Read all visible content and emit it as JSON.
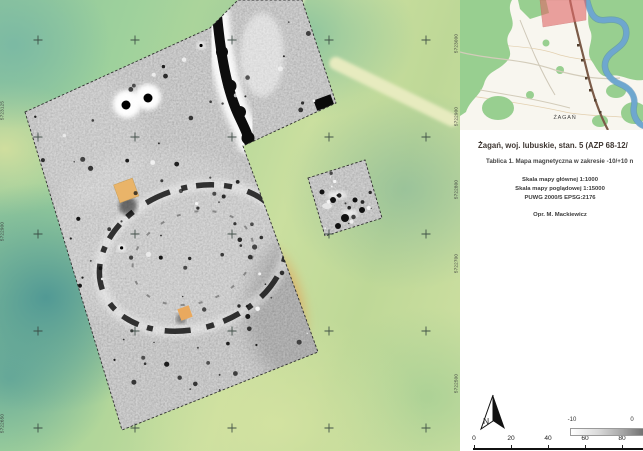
{
  "main_map": {
    "coordinate_labels": [
      {
        "text": "5723000",
        "y": 45
      },
      {
        "text": "5722900",
        "y": 118
      },
      {
        "text": "5722800",
        "y": 191
      },
      {
        "text": "5722700",
        "y": 265
      },
      {
        "text": "5722500",
        "y": 385
      }
    ]
  },
  "sidebar": {
    "edge_labels": [
      {
        "text": "5723125",
        "y": 112
      },
      {
        "text": "5722900",
        "y": 233
      },
      {
        "text": "5722650",
        "y": 425
      }
    ]
  },
  "overview_map": {
    "city_label": "ŻAGAŃ"
  },
  "info_panel": {
    "title": "Żagań, woj. lubuskie, stan. 5 (AZP 68-12/",
    "subtitle": "Tablica 1. Mapa magnetyczna w zakresie -10/+10 n",
    "scale_main": "Skala mapy głównej 1:1000",
    "scale_overview": "Skala mapy poglądowej 1:15000",
    "crs": "PUWG 2000/5 EPSG:2176",
    "author": "Opr. M. Mackiewicz"
  },
  "compass": {
    "label": "N"
  },
  "colorbar": {
    "labels": [
      {
        "text": "-10",
        "x": 572
      },
      {
        "text": "0",
        "x": 632
      }
    ]
  },
  "scalebar": {
    "ticks": [
      {
        "text": "0",
        "x": 474
      },
      {
        "text": "20",
        "x": 511
      },
      {
        "text": "40",
        "x": 548
      },
      {
        "text": "60",
        "x": 585
      },
      {
        "text": "80",
        "x": 622
      }
    ]
  },
  "colors": {
    "site_marker_red": "#e06a6a",
    "terrain_green": "#9dcf9b",
    "river_blue": "#6ea7cf",
    "survey_grey": "#9a9a9a",
    "building_orange": "#e9b469"
  }
}
